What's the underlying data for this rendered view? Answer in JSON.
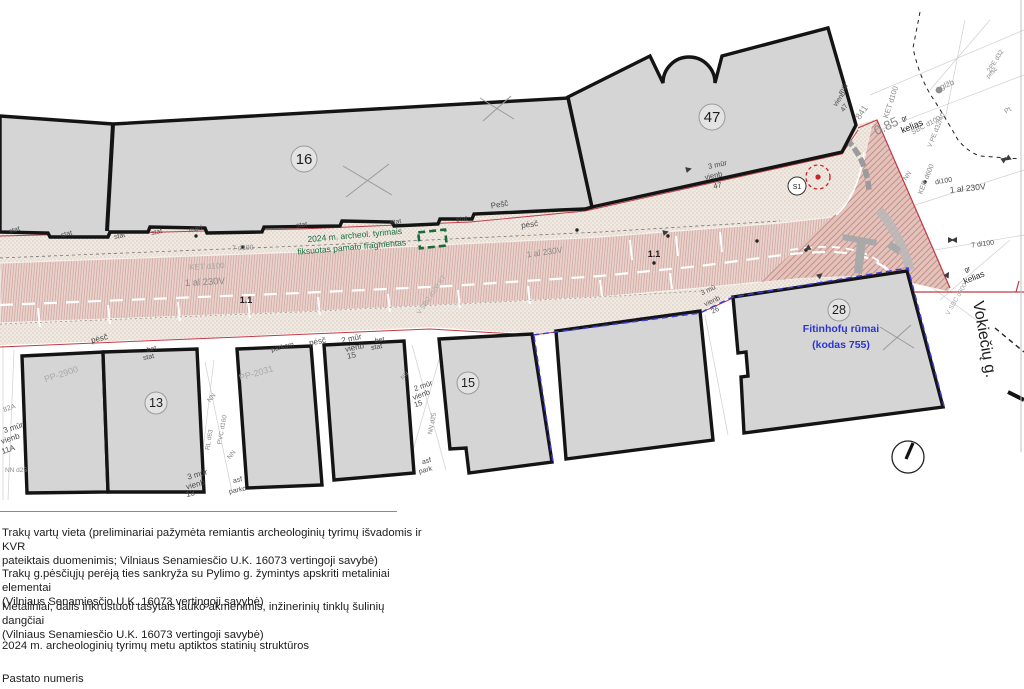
{
  "title": "Site plan — Vokiečių g. (archaeological survey plan)",
  "colors": {
    "gray": "#8a8a8a",
    "lightgray": "#a8a8a8",
    "dark": "#4a4a4a",
    "black": "#1e1e1e",
    "green": "#1a6b3c",
    "blue": "#2b35cf",
    "red": "#c03a43",
    "building_fill": "#d5d5d5",
    "building_stroke": "#141414",
    "road_base": "#e9d2cc",
    "sidewalk_base": "#f1eae3",
    "blue_dash": "#3a3ad6"
  },
  "map": {
    "street_name": "Vokiečių g.",
    "circled_numbers": [
      {
        "n": "16",
        "x": 304,
        "y": 159,
        "rr": 13
      },
      {
        "n": "47",
        "x": 712,
        "y": 117,
        "rr": 13
      },
      {
        "n": "13",
        "x": 156,
        "y": 403,
        "rr": 11
      },
      {
        "n": "15",
        "x": 468,
        "y": 383,
        "rr": 11
      },
      {
        "n": "28",
        "x": 839,
        "y": 310,
        "rr": 11
      }
    ],
    "labels": [
      {
        "t": "Fitinhofų rūmai",
        "x": 841,
        "y": 332,
        "s": 10.5,
        "r": 0,
        "c": "blue",
        "w": "bold"
      },
      {
        "t": "(kodas 755)",
        "x": 841,
        "y": 348,
        "s": 10.5,
        "r": 0,
        "c": "blue",
        "w": "bold"
      },
      {
        "t": "Vokiečių g.",
        "x": 973,
        "y": 302,
        "s": 16,
        "r": 80,
        "c": "black",
        "a": "start"
      },
      {
        "t": "2024 m. archeol. tyrimais",
        "x": 355,
        "y": 238,
        "s": 8.5,
        "r": -5,
        "c": "green"
      },
      {
        "t": "fiksuotas pamato fragmentas",
        "x": 352,
        "y": 250,
        "s": 8.5,
        "r": -5,
        "c": "green"
      },
      {
        "t": "S1",
        "x": 797,
        "y": 189,
        "s": 7,
        "r": 0,
        "c": "black"
      },
      {
        "t": "1.1",
        "x": 246,
        "y": 303,
        "s": 9,
        "r": 0,
        "c": "black",
        "w": "bold"
      },
      {
        "t": "1.1",
        "x": 654,
        "y": 257,
        "s": 9,
        "r": 0,
        "c": "black",
        "w": "bold"
      },
      {
        "t": "KET d100",
        "x": 207,
        "y": 269,
        "s": 8,
        "r": -3,
        "c": "lightgray"
      },
      {
        "t": "1 al 230V",
        "x": 205,
        "y": 285,
        "s": 9.5,
        "r": -3,
        "c": "gray"
      },
      {
        "t": "1 al 230V",
        "x": 545,
        "y": 255,
        "s": 8.5,
        "r": -8,
        "c": "gray"
      },
      {
        "t": "1 al 230V",
        "x": 968,
        "y": 191,
        "s": 8.5,
        "r": -6,
        "c": "dark"
      },
      {
        "t": "di100",
        "x": 944,
        "y": 183,
        "s": 7,
        "r": -10,
        "c": "dark"
      },
      {
        "t": "7 d100",
        "x": 243,
        "y": 250,
        "s": 7,
        "r": -3,
        "c": "gray"
      },
      {
        "t": "7 di100",
        "x": 983,
        "y": 246,
        "s": 7,
        "r": -8,
        "c": "dark"
      },
      {
        "t": "KET d100",
        "x": 893,
        "y": 103,
        "s": 7.5,
        "r": -72,
        "c": "gray"
      },
      {
        "t": "SBC d100",
        "x": 927,
        "y": 127,
        "s": 7,
        "r": -28,
        "c": "gray"
      },
      {
        "t": "V PE d32/40",
        "x": 938,
        "y": 131,
        "s": 6.5,
        "r": -68,
        "c": "gray"
      },
      {
        "t": "KER d600",
        "x": 928,
        "y": 180,
        "s": 7,
        "r": -68,
        "c": "gray"
      },
      {
        "t": "NN",
        "x": 909,
        "y": 177,
        "s": 6.5,
        "r": -55,
        "c": "gray"
      },
      {
        "t": "NN",
        "x": 213,
        "y": 399,
        "s": 6.5,
        "r": -50,
        "c": "gray"
      },
      {
        "t": "NN",
        "x": 233,
        "y": 456,
        "s": 6.5,
        "r": -50,
        "c": "gray"
      },
      {
        "t": "PVC d160",
        "x": 224,
        "y": 430,
        "s": 6.5,
        "r": -80,
        "c": "gray"
      },
      {
        "t": "RL d63",
        "x": 211,
        "y": 440,
        "s": 6.5,
        "r": -80,
        "c": "gray"
      },
      {
        "t": "NN d25",
        "x": 434,
        "y": 424,
        "s": 6.5,
        "r": -78,
        "c": "gray"
      },
      {
        "t": "NN d25",
        "x": 16,
        "y": 472,
        "s": 6.5,
        "r": 0,
        "c": "gray"
      },
      {
        "t": "NN",
        "x": 406,
        "y": 377,
        "s": 6,
        "r": -45,
        "c": "gray"
      },
      {
        "t": "82A",
        "x": 10,
        "y": 410,
        "s": 7,
        "r": -20,
        "c": "gray"
      },
      {
        "t": "3 mūr",
        "x": 14,
        "y": 430,
        "s": 8,
        "r": -18,
        "c": "dark"
      },
      {
        "t": "vienb",
        "x": 11,
        "y": 441,
        "s": 8,
        "r": -18,
        "c": "dark"
      },
      {
        "t": "11A",
        "x": 9,
        "y": 452,
        "s": 8,
        "r": -18,
        "c": "dark"
      },
      {
        "t": "3 mūr",
        "x": 198,
        "y": 477,
        "s": 8,
        "r": -15,
        "c": "dark"
      },
      {
        "t": "vienb",
        "x": 196,
        "y": 487,
        "s": 8,
        "r": -15,
        "c": "dark"
      },
      {
        "t": "13",
        "x": 191,
        "y": 496,
        "s": 8,
        "r": -15,
        "c": "dark"
      },
      {
        "t": "asf",
        "x": 238,
        "y": 482,
        "s": 7,
        "r": -12,
        "c": "dark"
      },
      {
        "t": "parko",
        "x": 238,
        "y": 492,
        "s": 7,
        "r": -12,
        "c": "dark"
      },
      {
        "t": "asf",
        "x": 427,
        "y": 463,
        "s": 7,
        "r": -15,
        "c": "dark"
      },
      {
        "t": "park",
        "x": 426,
        "y": 472,
        "s": 7,
        "r": -15,
        "c": "dark"
      },
      {
        "t": "2 mūr",
        "x": 424,
        "y": 388,
        "s": 7.5,
        "r": -20,
        "c": "dark"
      },
      {
        "t": "vienb",
        "x": 422,
        "y": 397,
        "s": 7.5,
        "r": -20,
        "c": "dark"
      },
      {
        "t": "15",
        "x": 419,
        "y": 406,
        "s": 7.5,
        "r": -20,
        "c": "dark"
      },
      {
        "t": "2 mūr",
        "x": 352,
        "y": 341,
        "s": 8,
        "r": -12,
        "c": "dark"
      },
      {
        "t": "vienb",
        "x": 355,
        "y": 350,
        "s": 8,
        "r": -12,
        "c": "dark"
      },
      {
        "t": "15",
        "x": 352,
        "y": 358,
        "s": 8,
        "r": -12,
        "c": "dark"
      },
      {
        "t": "bet",
        "x": 152,
        "y": 351,
        "s": 7,
        "r": -12,
        "c": "dark"
      },
      {
        "t": "stat",
        "x": 149,
        "y": 359,
        "s": 7,
        "r": -12,
        "c": "dark"
      },
      {
        "t": "bet",
        "x": 380,
        "y": 342,
        "s": 7,
        "r": -10,
        "c": "dark"
      },
      {
        "t": "stat",
        "x": 377,
        "y": 349,
        "s": 7,
        "r": -10,
        "c": "dark"
      },
      {
        "t": "parkom",
        "x": 283,
        "y": 349,
        "s": 7,
        "r": -14,
        "c": "dark"
      },
      {
        "t": "pėsč",
        "x": 100,
        "y": 341,
        "s": 8,
        "r": -14,
        "c": "dark"
      },
      {
        "t": "pėsč",
        "x": 318,
        "y": 344,
        "s": 8,
        "r": -10,
        "c": "dark"
      },
      {
        "t": "pėsč",
        "x": 530,
        "y": 227,
        "s": 8,
        "r": -8,
        "c": "dark"
      },
      {
        "t": "Pešč",
        "x": 500,
        "y": 207,
        "s": 8,
        "r": -10,
        "c": "dark"
      },
      {
        "t": "pėsč",
        "x": 993,
        "y": 74,
        "s": 6,
        "r": -45,
        "c": "gray"
      },
      {
        "t": "stat",
        "x": 15,
        "y": 232,
        "s": 7,
        "r": -18,
        "c": "dark"
      },
      {
        "t": "stat",
        "x": 67,
        "y": 236,
        "s": 7,
        "r": -14,
        "c": "dark"
      },
      {
        "t": "stat",
        "x": 120,
        "y": 238,
        "s": 7,
        "r": -12,
        "c": "dark"
      },
      {
        "t": "stat",
        "x": 157,
        "y": 234,
        "s": 7,
        "r": -12,
        "c": "dark"
      },
      {
        "t": "med",
        "x": 196,
        "y": 231,
        "s": 7,
        "r": -12,
        "c": "dark"
      },
      {
        "t": "stat",
        "x": 302,
        "y": 227,
        "s": 7,
        "r": -8,
        "c": "dark"
      },
      {
        "t": "stat",
        "x": 396,
        "y": 224,
        "s": 7,
        "r": -8,
        "c": "dark"
      },
      {
        "t": "stat",
        "x": 462,
        "y": 221,
        "s": 7,
        "r": -8,
        "c": "dark"
      },
      {
        "t": "3 mūr",
        "x": 718,
        "y": 167,
        "s": 7.5,
        "r": -12,
        "c": "dark"
      },
      {
        "t": "vienb",
        "x": 714,
        "y": 178,
        "s": 7.5,
        "r": -12,
        "c": "dark"
      },
      {
        "t": "47",
        "x": 718,
        "y": 188,
        "s": 7.5,
        "r": -12,
        "c": "dark"
      },
      {
        "t": "mūr",
        "x": 845,
        "y": 90,
        "s": 7,
        "r": -55,
        "c": "dark"
      },
      {
        "t": "vienb",
        "x": 841,
        "y": 100,
        "s": 7,
        "r": -55,
        "c": "dark"
      },
      {
        "t": "47",
        "x": 846,
        "y": 109,
        "s": 7,
        "r": -55,
        "c": "dark"
      },
      {
        "t": "3 mū",
        "x": 709,
        "y": 292,
        "s": 7,
        "r": -25,
        "c": "dark"
      },
      {
        "t": "vienb",
        "x": 713,
        "y": 303,
        "s": 7,
        "r": -25,
        "c": "dark"
      },
      {
        "t": "26",
        "x": 716,
        "y": 312,
        "s": 7,
        "r": -25,
        "c": "dark"
      },
      {
        "t": "PP-2900",
        "x": 62,
        "y": 377,
        "s": 9,
        "r": -18,
        "c": "lightgray"
      },
      {
        "t": "PP-2031",
        "x": 257,
        "y": 376,
        "s": 9,
        "r": -16,
        "c": "lightgray"
      },
      {
        "t": "841",
        "x": 864,
        "y": 114,
        "s": 9,
        "r": -55,
        "c": "gray"
      },
      {
        "t": "0.85",
        "x": 888,
        "y": 130,
        "s": 13,
        "r": -26,
        "c": "gray"
      },
      {
        "t": "kelias",
        "x": 913,
        "y": 129,
        "s": 9,
        "r": -22,
        "c": "black"
      },
      {
        "t": "gr",
        "x": 905,
        "y": 120,
        "s": 6.5,
        "r": -22,
        "c": "black"
      },
      {
        "t": "kelias",
        "x": 975,
        "y": 280,
        "s": 8.5,
        "r": -22,
        "c": "black"
      },
      {
        "t": "gr",
        "x": 968,
        "y": 271,
        "s": 6.5,
        "r": -22,
        "c": "black"
      },
      {
        "t": "glžb",
        "x": 948,
        "y": 87,
        "s": 8,
        "r": -22,
        "c": "gray"
      },
      {
        "t": "2PE d32",
        "x": 997,
        "y": 62,
        "s": 6.5,
        "r": -58,
        "c": "gray"
      },
      {
        "t": "Pt",
        "x": 1009,
        "y": 112,
        "s": 7,
        "r": -35,
        "c": "gray"
      },
      {
        "t": "V SBC d100 KT",
        "x": 433,
        "y": 296,
        "s": 6.5,
        "r": -55,
        "c": "lightgray"
      },
      {
        "t": "V SBC d600",
        "x": 958,
        "y": 300,
        "s": 6.5,
        "r": -60,
        "c": "lightgray"
      }
    ]
  },
  "annotations": {
    "found_fragment_label": "2024 m. archeol. tyrimais fiksuotas pamato fragmentas",
    "trench_label": "S1",
    "palace_label": "Fitinhofų rūmai (kodas 755)"
  },
  "legend": {
    "items": [
      {
        "lines": [
          "Trakų vartų vieta (preliminariai pažymėta remiantis archeologinių tyrimų išvadomis ir KVR",
          "pateiktais duomenimis; Vilniaus Senamiesčio U.K. 16073 vertingoji savybė)"
        ]
      },
      {
        "lines": [
          "Trakų g.pėsčiųjų perėją ties sankryža su Pylimo g. žymintys apskriti metaliniai elementai",
          "(Vilniaus Senamiesčio U.K. 16073 vertingoji savybė)"
        ]
      },
      {
        "lines": [
          "Metaliniai, dalis inkrustuoti tašytais lauko akmenimis, inžinerinių tinklų šulinių dangčiai",
          "(Vilniaus Senamiesčio U.K. 16073 vertingoji savybė)"
        ]
      },
      {
        "lines": [
          "2024 m. archeologinių tyrimų metu aptiktos statinių struktūros"
        ]
      },
      {
        "lines": [
          "Pastato numeris"
        ]
      }
    ]
  }
}
